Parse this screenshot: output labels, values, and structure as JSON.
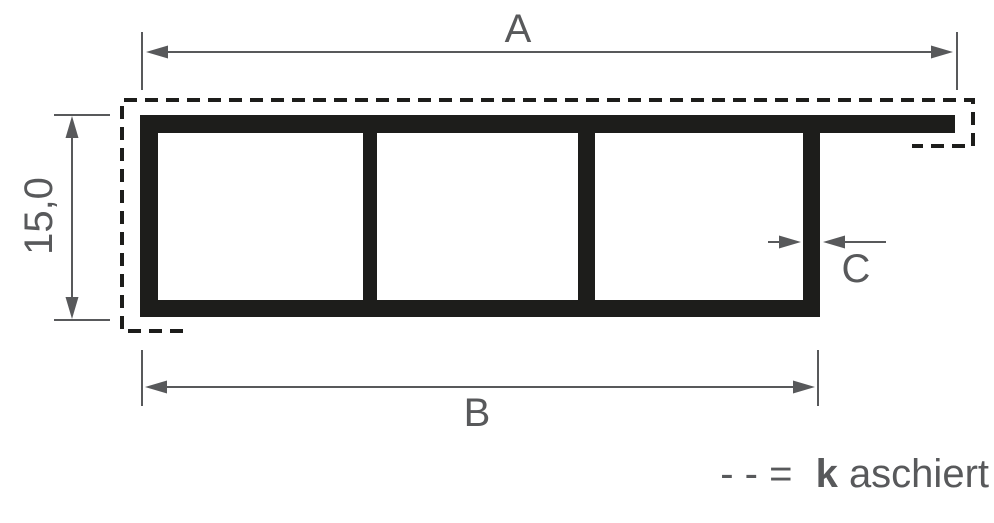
{
  "figure": {
    "type": "profile-cross-section-drawing",
    "labels": {
      "dim_a": "A",
      "dim_b": "B",
      "dim_c": "C",
      "dim_height": "15,0"
    },
    "legend": {
      "symbol": "- - =",
      "term_bold": "k",
      "term_rest": "aschiert"
    },
    "colors": {
      "profile": "#1d1d1b",
      "dimension_lines": "#58595b",
      "background": "#ffffff"
    }
  }
}
